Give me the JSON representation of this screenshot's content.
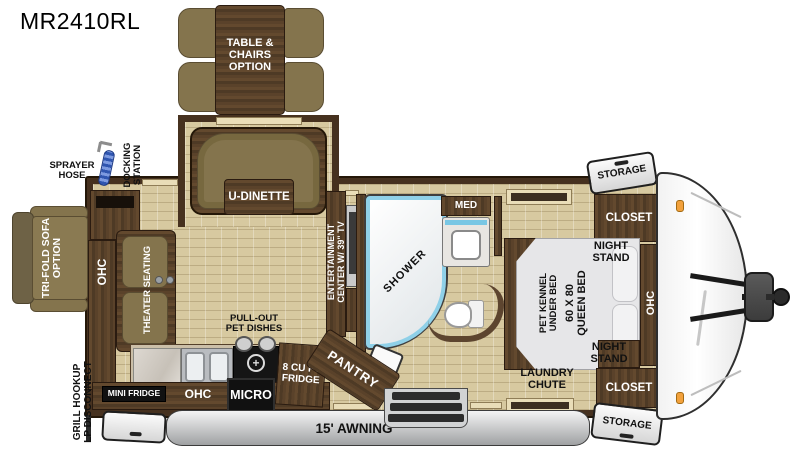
{
  "title": "MR2410RL",
  "labels": {
    "table_chairs": "TABLE & CHAIRS OPTION",
    "u_dinette": "U-DINETTE",
    "sprayer_hose": "SPRAYER HOSE",
    "docking_line1": "DOCKING",
    "docking_line2": "STATION",
    "sofa_line1": "TRI-FOLD SOFA",
    "sofa_line2": "OPTION",
    "ohc": "OHC",
    "theater": "THEATER SEATING",
    "ent_line1": "ENTERTAINMENT",
    "ent_line2": "CENTER W/ 39\" TV",
    "shower": "SHOWER",
    "med": "MED",
    "pet_dishes": "PULL-OUT PET DISHES",
    "mini_fridge": "MINI FRIDGE",
    "micro": "MICRO",
    "fridge": "8 CU FT FRIDGE",
    "pantry": "PANTRY",
    "grill_line1": "GRILL HOOKUP",
    "grill_line2": "LP DISCONNECT",
    "awning": "15' AWNING",
    "storage": "STORAGE",
    "closet": "CLOSET",
    "night_stand": "NIGHT STAND",
    "bed_line1": "60 X 80",
    "bed_line2": "QUEEN BED",
    "kennel_line1": "PET KENNEL",
    "kennel_line2": "UNDER BED",
    "laundry": "LAUNDRY CHUTE"
  },
  "colors": {
    "wall_brown": "#46311f",
    "wood": "#5a422a",
    "floor_tan": "#d7c9a0",
    "cushion_olive": "#84744d",
    "shower_blue": "#79c7e4",
    "awning_gray": "#b9babc",
    "marker_orange": "#f2a13c"
  }
}
